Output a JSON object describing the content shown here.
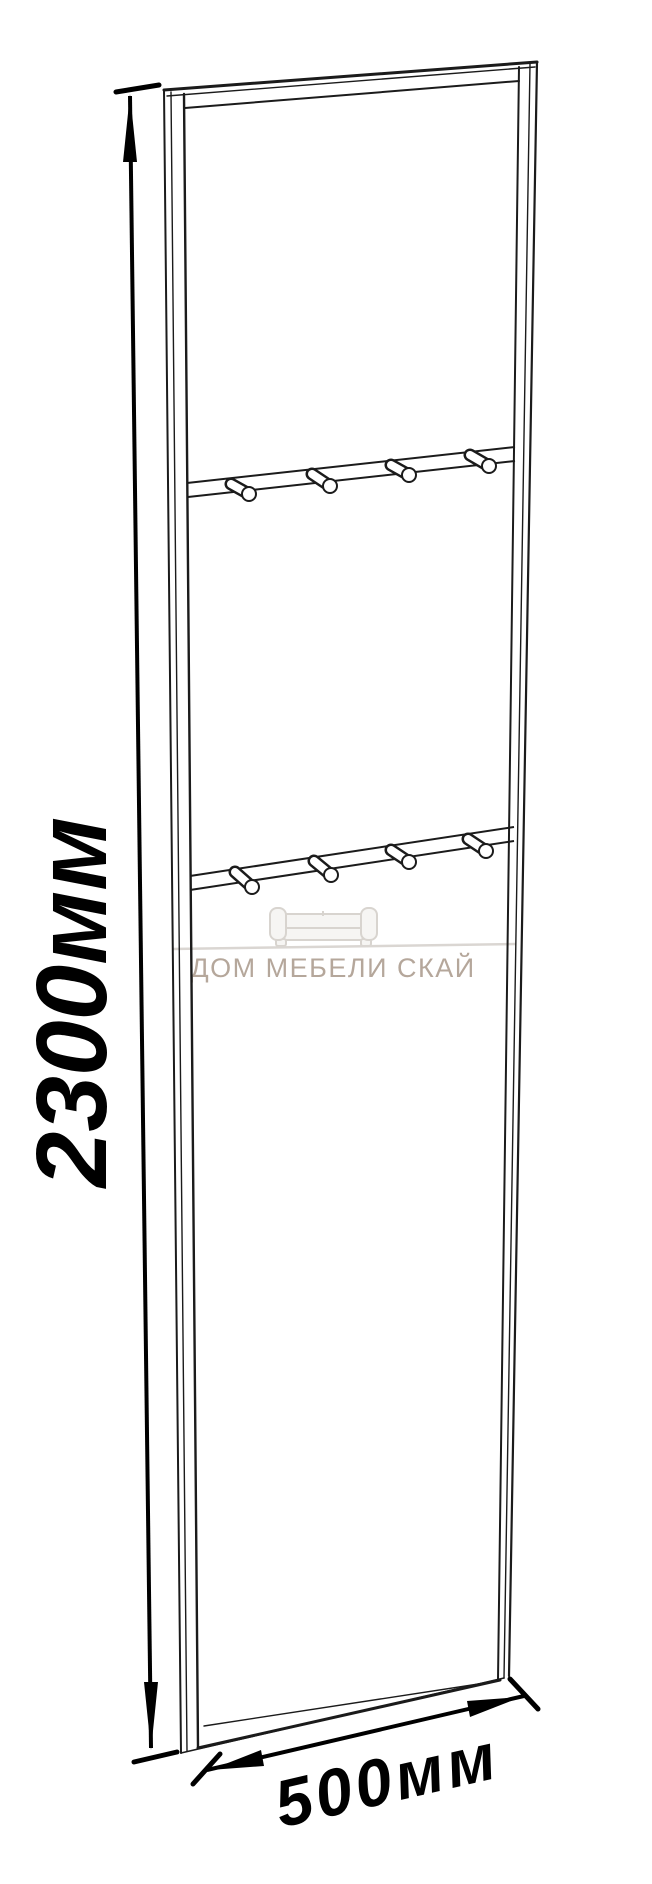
{
  "canvas": {
    "width": 652,
    "height": 1884,
    "background": "#ffffff",
    "line_color": "#1b1b1b"
  },
  "dimensions": {
    "height": {
      "label": "2300мм",
      "color": "#000000"
    },
    "width": {
      "label": "500мм",
      "color": "#000000"
    }
  },
  "panel": {
    "hook_rows": 2,
    "hooks_per_row": 4,
    "total_hooks": 8
  },
  "watermark": {
    "text": "ДОМ МЕБЕЛИ СКАЙ",
    "icon": "sofa-icon",
    "text_color": "#b5a79b",
    "icon_stroke": "#d8d4cf",
    "icon_fill": "#f6f5f3"
  }
}
